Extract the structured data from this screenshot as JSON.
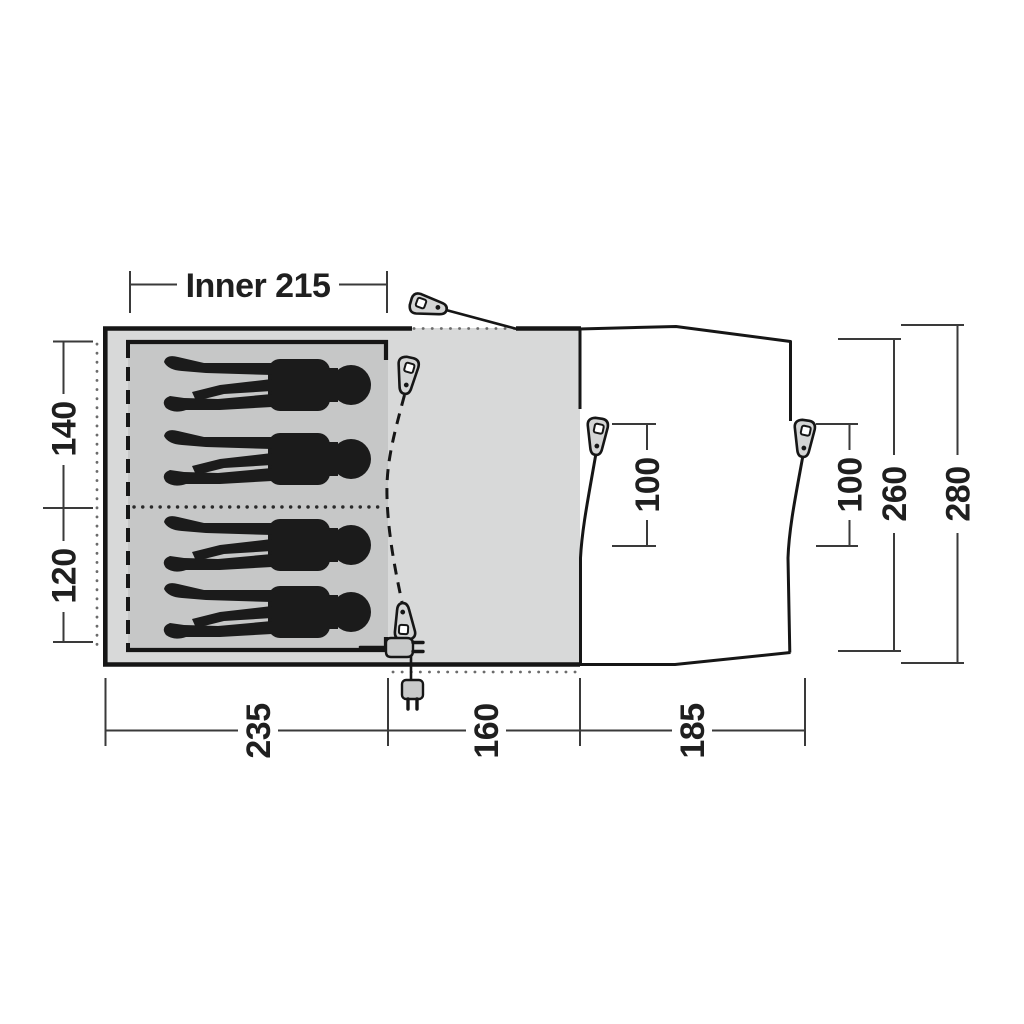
{
  "figure": {
    "kind": "tent floor plan top view",
    "sleeping_capacity": 4
  },
  "labels": {
    "inner_width": "Inner 215",
    "left": {
      "rear_section": "140",
      "front_section": "120"
    },
    "bottom": {
      "bedroom_depth": "235",
      "living_depth": "160",
      "porch_depth": "185"
    },
    "doors": {
      "left_opening": "100",
      "right_opening": "100"
    },
    "right": {
      "porch_span": "260",
      "total_span": "280"
    }
  },
  "icons": {
    "guy_peg": "tent-peg-icon",
    "guy_peg_count": 5,
    "power_plug_inner": "power-plug-icon",
    "power_plug_outer": "power-plug-icon",
    "person_silhouette_count": 4
  },
  "colors": {
    "canvas": "#ffffff",
    "tent_body_fill": "#d8d9d9",
    "inner_tent_fill": "#c6c7c7",
    "porch_fill": "#ffffff",
    "outline": "#161616",
    "dimension_lines": "#3a3a3a",
    "silhouette": "#1b1b1b"
  }
}
